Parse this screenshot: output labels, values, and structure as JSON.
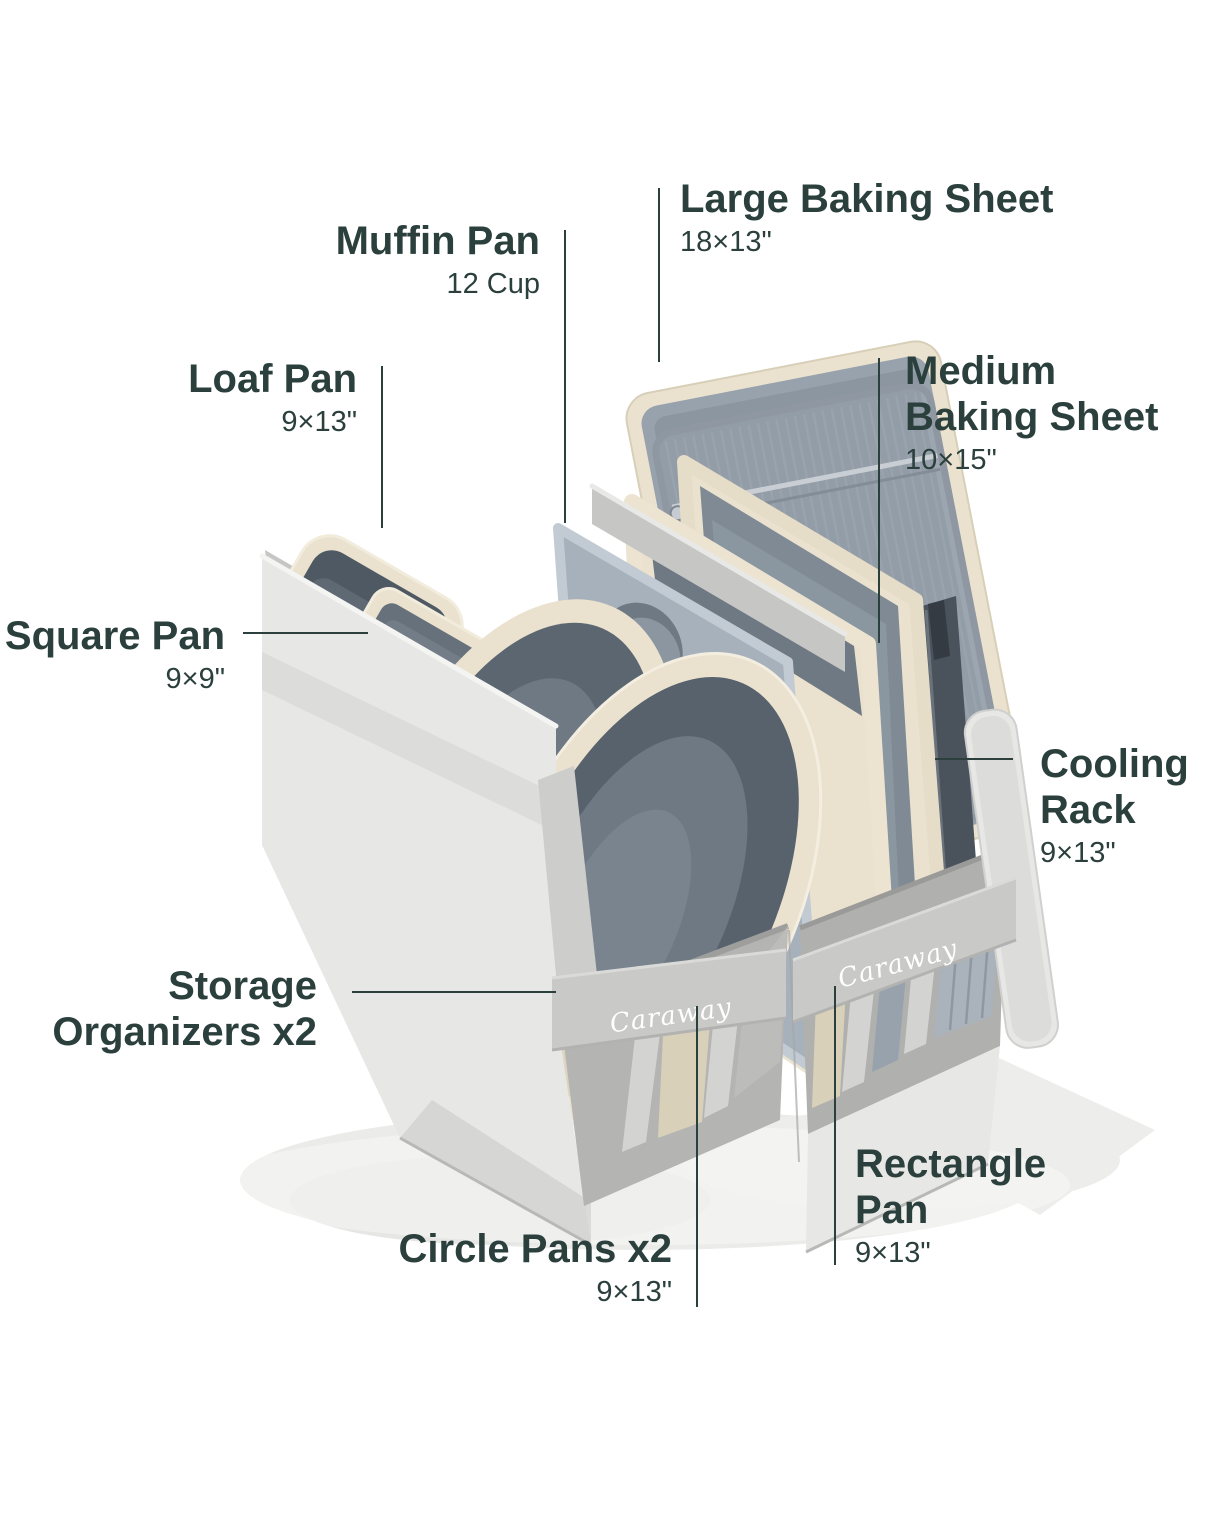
{
  "brand": {
    "logo_text": "Caraway"
  },
  "labels": {
    "large_baking_sheet": {
      "title": "Large Baking Sheet",
      "dim": "18×13\""
    },
    "muffin_pan": {
      "title": "Muffin Pan",
      "dim": "12 Cup"
    },
    "loaf_pan": {
      "title": "Loaf Pan",
      "dim": "9×13\""
    },
    "square_pan": {
      "title": "Square Pan",
      "dim": "9×9\""
    },
    "medium_baking_sheet": {
      "line1": "Medium",
      "line2": "Baking Sheet",
      "dim": "10×15\""
    },
    "cooling_rack": {
      "line1": "Cooling",
      "line2": "Rack",
      "dim": "9×13\""
    },
    "storage_organizers": {
      "line1": "Storage",
      "line2": "Organizers x2"
    },
    "circle_pans": {
      "title": "Circle Pans x2",
      "dim": "9×13\""
    },
    "rectangle_pan": {
      "line1": "Rectangle",
      "line2": "Pan",
      "dim": "9×13\""
    }
  },
  "colors": {
    "background": "#ffffff",
    "label_text": "#2b403d",
    "callout_line": "#2b403d",
    "fabric_light": "#e7e7e5",
    "fabric_mid": "#d3d3d1",
    "fabric_dark": "#bcbcba",
    "strap": "#c9cac8",
    "pan_cream": "#eae2cf",
    "pan_cream_deep": "#d9d0ba",
    "pan_interior_dark": "#57626d",
    "pan_interior_mid": "#6e7984",
    "metal_gray": "#97a2ad",
    "rack_wire": "#9aa3ad",
    "logo_text_color": "#ffffff"
  }
}
